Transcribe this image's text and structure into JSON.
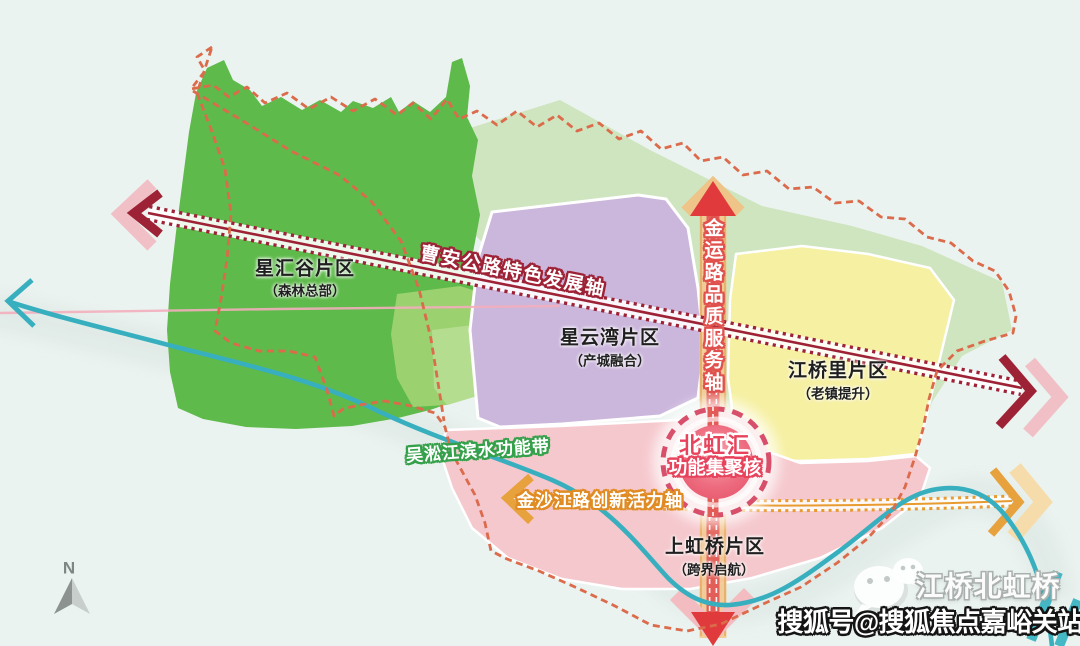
{
  "map": {
    "compass_label": "N",
    "regions": [
      {
        "id": "xinghuigu",
        "name": "星汇谷片区",
        "subtitle": "（森林总部）",
        "fill": "#5eba4a"
      },
      {
        "id": "xingyunwan",
        "name": "星云湾片区",
        "subtitle": "（产城融合）",
        "fill": "#cbb6dc"
      },
      {
        "id": "jiangqiaoli",
        "name": "江桥里片区",
        "subtitle": "（老镇提升）",
        "fill": "#f6f0a2"
      },
      {
        "id": "shanghongqiao",
        "name": "上虹桥片区",
        "subtitle": "（跨界启航）",
        "fill": "#f5c8cd"
      }
    ],
    "core_node": {
      "title": "北虹汇",
      "subtitle": "功能集聚核",
      "ring_color": "#d84f6b"
    },
    "axes": [
      {
        "id": "caoan",
        "label": "曹安公路特色发展轴",
        "color": "#9e2236",
        "style": "railway-diagonal"
      },
      {
        "id": "jinyun",
        "label": "金运路品质服务轴",
        "color": "#e25b57",
        "style": "vertical-band"
      },
      {
        "id": "jinshajiang",
        "label": "金沙江路创新活力轴",
        "color": "#e89b2f",
        "style": "dotted-horizontal"
      }
    ],
    "water_belt": {
      "label": "吴淞江滨水功能带",
      "color": "#38afbf"
    },
    "boundary_color": "#db6b4b"
  },
  "watermark": {
    "icon": "wechat-icon",
    "source_line": "江桥北虹桥",
    "account_line": "搜狐号@搜狐焦点嘉峪关站"
  }
}
